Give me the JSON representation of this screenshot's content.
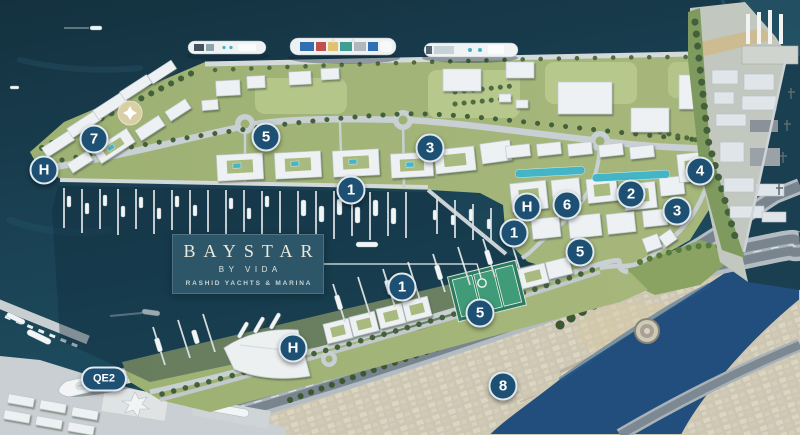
{
  "page": {
    "title": "Baystar by Vida — Rashid Yachts & Marina masterplan"
  },
  "logo_card": {
    "brand": "BAYSTAR",
    "by_line": "BY VIDA",
    "tagline": "RASHID YACHTS & MARINA",
    "background": "#2e5669",
    "text_color": "#ece8da"
  },
  "markers": {
    "style": {
      "fill": "#1d5072",
      "ring": "#dfe9f0",
      "text_color": "#ffffff"
    },
    "items": [
      {
        "label": "7",
        "x": 94,
        "y": 139,
        "shape": "circle"
      },
      {
        "label": "H",
        "x": 44,
        "y": 170,
        "shape": "circle"
      },
      {
        "label": "5",
        "x": 266,
        "y": 137,
        "shape": "circle"
      },
      {
        "label": "3",
        "x": 430,
        "y": 148,
        "shape": "circle"
      },
      {
        "label": "1",
        "x": 351,
        "y": 190,
        "shape": "circle"
      },
      {
        "label": "4",
        "x": 700,
        "y": 171,
        "shape": "circle"
      },
      {
        "label": "2",
        "x": 631,
        "y": 194,
        "shape": "circle"
      },
      {
        "label": "3",
        "x": 677,
        "y": 211,
        "shape": "circle"
      },
      {
        "label": "H",
        "x": 527,
        "y": 207,
        "shape": "circle"
      },
      {
        "label": "6",
        "x": 567,
        "y": 205,
        "shape": "circle"
      },
      {
        "label": "1",
        "x": 514,
        "y": 233,
        "shape": "circle"
      },
      {
        "label": "5",
        "x": 580,
        "y": 252,
        "shape": "circle"
      },
      {
        "label": "1",
        "x": 402,
        "y": 287,
        "shape": "circle"
      },
      {
        "label": "5",
        "x": 480,
        "y": 313,
        "shape": "circle"
      },
      {
        "label": "H",
        "x": 293,
        "y": 348,
        "shape": "circle"
      },
      {
        "label": "8",
        "x": 503,
        "y": 386,
        "shape": "circle"
      },
      {
        "label": "QE2",
        "x": 104,
        "y": 379,
        "shape": "pill"
      }
    ]
  },
  "scene_palette": {
    "water": "#1a4254",
    "creek_water": "#214e7c",
    "land_green": "#9fb276",
    "old_town_beige": "#ccc6b3",
    "building_white": "#eef1f3",
    "pool_teal": "#44b5c7"
  }
}
